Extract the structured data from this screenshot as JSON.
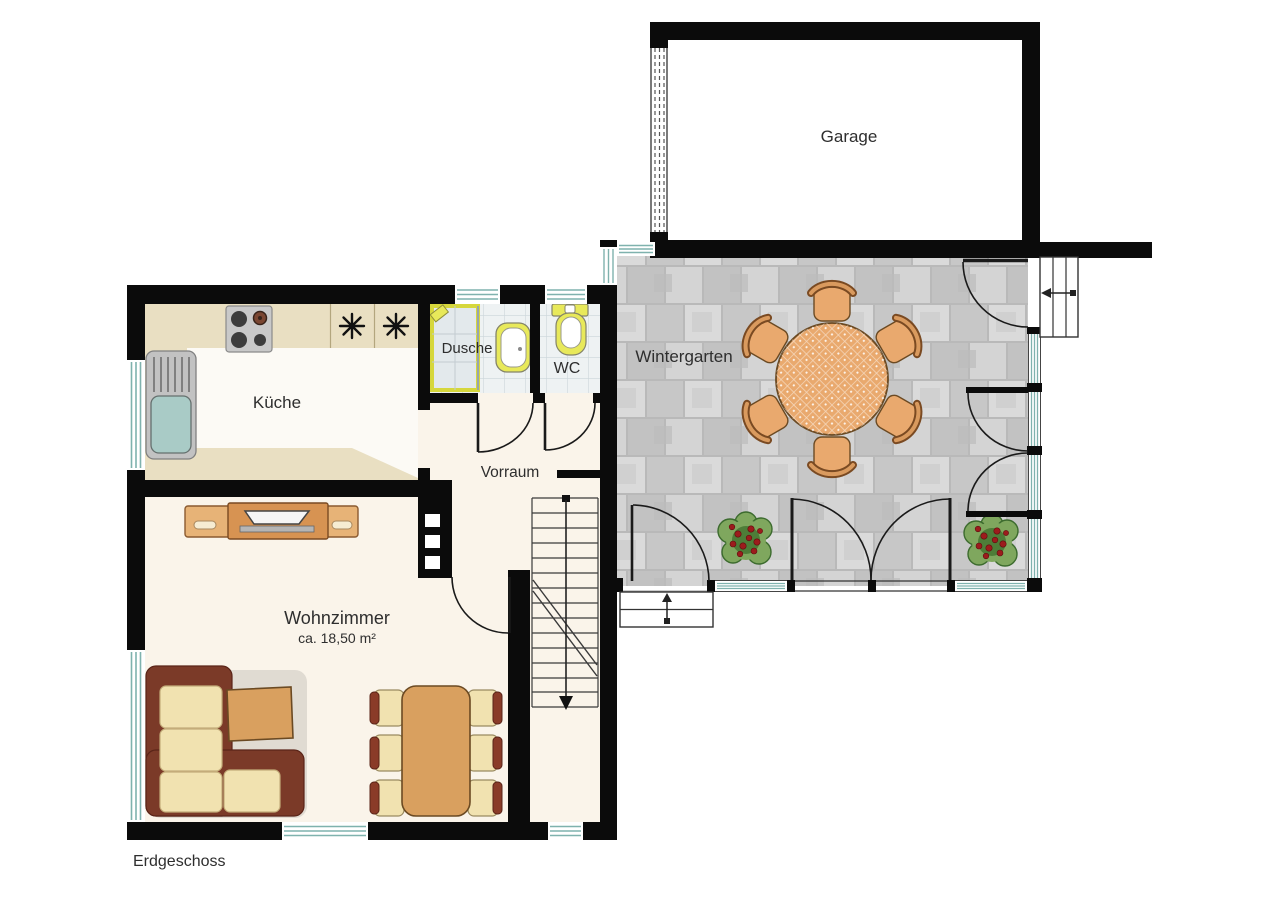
{
  "plan": {
    "floor_label": "Erdgeschoss",
    "rooms": {
      "garage": {
        "label": "Garage"
      },
      "wintergarten": {
        "label": "Wintergarten"
      },
      "kueche": {
        "label": "Küche"
      },
      "dusche": {
        "label": "Dusche"
      },
      "wc": {
        "label": "WC"
      },
      "vorraum": {
        "label": "Vorraum"
      },
      "wohnzimmer": {
        "label": "Wohnzimmer",
        "area": "ca. 18,50 m²"
      }
    },
    "icons": [
      "freezer-star-icon",
      "stove-burners-icon",
      "sink-icon",
      "shower-tray-icon",
      "washbasin-icon",
      "toilet-icon",
      "door-swing-arc-icon",
      "window-glazing-icon",
      "stair-walkline-arrow-icon",
      "exterior-steps-arrow-icon",
      "plant-icon",
      "round-table-icon",
      "chair-icon",
      "garage-door-icon",
      "tv-sideboard-icon",
      "sofa-icon",
      "coffee-table-icon",
      "dining-table-icon",
      "chimney-icon"
    ],
    "colors": {
      "wall_black": "#0b0b0b",
      "floor_cream": "#faf4ea",
      "kitchen_beige": "#e9dfc2",
      "kitchen_floor_white": "#fcfaf5",
      "stone_tile_gray": "#cfcfcf",
      "bath_tile": "#eef2f3",
      "glazing_teal": "#7fb2ae",
      "wood_tan": "#e9a96e",
      "wood_outline": "#6b4a23",
      "furniture_tan": "#d9a05f",
      "sofa_cream": "#f1e2b0",
      "sofa_back_brown": "#7b3a28",
      "fixture_yellow": "#e8e95a",
      "plant_green": "#6f9c52",
      "berry_red": "#9c1c1c"
    }
  }
}
